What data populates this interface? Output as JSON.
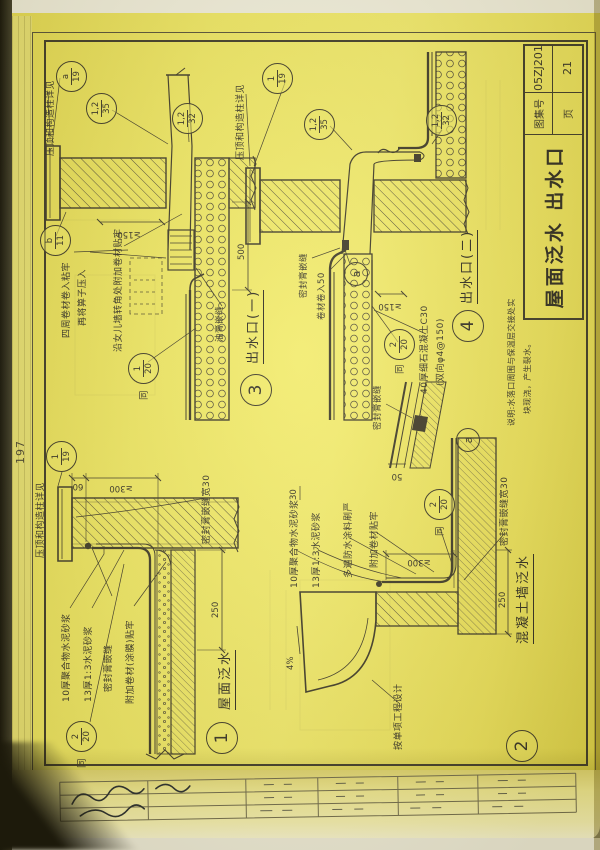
{
  "photo": {
    "page_number": "197"
  },
  "title_block": {
    "title": "屋面泛水 出水口",
    "atlas_label": "图集号",
    "atlas_value": "05ZJ201",
    "page_label": "页",
    "page_value": "21"
  },
  "note": {
    "line1": "说明:水落口周围与保温层交接处实",
    "line2": "块现浇，产生裂水。"
  },
  "d1": {
    "num": "1",
    "title": "屋面泛水",
    "cap_ref_label": "压顶和构造柱详见",
    "ref19": {
      "top": "1",
      "bot": "19"
    },
    "same": {
      "word": "同",
      "top": "2",
      "bot": "20"
    },
    "labels": [
      "10厚聚合物水泥砂浆",
      "13厚1:3水泥砂浆",
      "密封膏嵌缝",
      "附加卷材(涂膜)贴牢",
      "密封膏嵌缝宽30"
    ],
    "dims": {
      "h60": "60",
      "h300": "≥300",
      "w250": "250"
    }
  },
  "d2": {
    "num": "2",
    "title": "混凝土墙泛水",
    "slope": "4%",
    "project_label": "按单项工程设计",
    "same": {
      "word": "同",
      "top": "2",
      "bot": "20"
    },
    "labels": [
      "10厚聚合物水泥砂浆",
      "13厚1:3水泥砂浆",
      "多遍防水涂料刷严",
      "附加卷材贴牢",
      "密封膏嵌缝宽30"
    ],
    "dims": {
      "h300": "≥300",
      "w250": "250",
      "w30": "30"
    }
  },
  "d3": {
    "num": "3",
    "title": "出水口(一)",
    "cap_ref_label": "压顶和构造柱详见",
    "ref19": {
      "top": "a",
      "bot": "19"
    },
    "ref35": {
      "top": "1,2",
      "bot": "35"
    },
    "ref32": {
      "top": "1,2",
      "bot": "32"
    },
    "ref11": {
      "top": "b",
      "bot": "11"
    },
    "same": {
      "word": "同",
      "top": "1",
      "bot": "20"
    },
    "labels": [
      "四周卷材卷入粘牢",
      "再将箅子压入",
      "沿女儿墙转角处附加卷材贴牢",
      "油膏嵌缝"
    ],
    "dims": {
      "h150": "≥150",
      "w500": "500"
    }
  },
  "d4": {
    "num": "4",
    "title": "出水口(二)",
    "cap_ref_label": "压顶和构造柱详见",
    "ref19": {
      "top": "1",
      "bot": "19"
    },
    "ref35": {
      "top": "1,2",
      "bot": "35"
    },
    "ref32": {
      "top": "1,2",
      "bot": "32"
    },
    "refa": "a",
    "same": {
      "word": "同",
      "top": "2",
      "bot": "20"
    },
    "labels": [
      "密封膏嵌缝",
      "卷材卷入50",
      "40厚细石混凝土C30",
      "(双向φ4@150)"
    ],
    "dims": {
      "h150": "≥150"
    }
  },
  "da": {
    "num": "a",
    "seal_label": "密封膏嵌缝",
    "dims": {
      "w50": "50"
    }
  }
}
